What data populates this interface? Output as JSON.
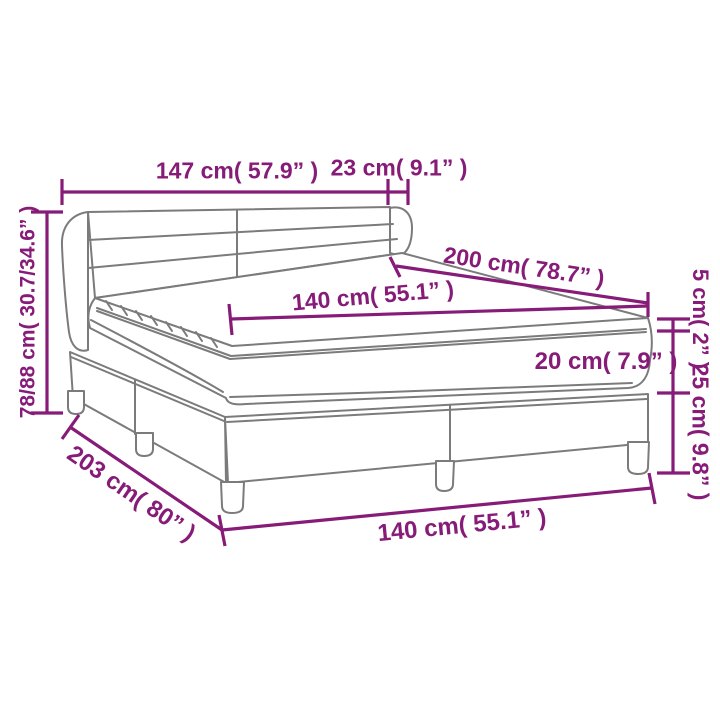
{
  "diagram": {
    "product": "box spring bed dimension diagram",
    "colors": {
      "dimension": "#871B78",
      "outline": "#7B7B7B",
      "background": "#FFFFFF"
    },
    "labels": {
      "headboard_width": "147 cm( 57.9” )",
      "headboard_side_depth": "23 cm( 9.1” )",
      "bed_length": "200 cm( 78.7” )",
      "mattress_width": "140 cm( 55.1” )",
      "overall_height": "78/88 cm( 30.7/34.6” )",
      "topper_thickness": "5 cm( 2” )",
      "mattress_thickness": "20 cm( 7.9” )",
      "base_height": "25 cm( 9.8” )",
      "frame_length": "203 cm( 80” )",
      "frame_width": "140 cm( 55.1” )"
    }
  }
}
